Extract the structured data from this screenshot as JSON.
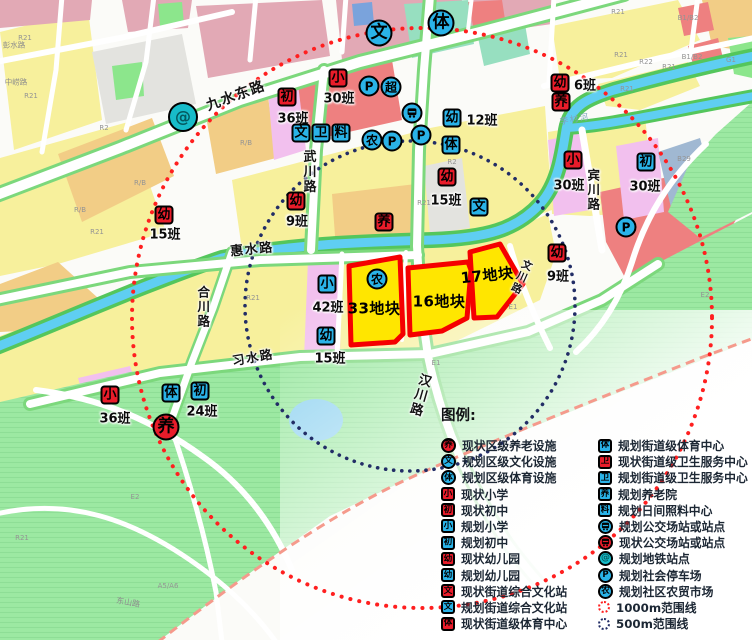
{
  "colors": {
    "marker_red": "#e91c2a",
    "marker_blue": "#2ab3e8",
    "metro_teal": "#17bcc9",
    "plot_fill": "#ffe600",
    "plot_stroke": "#f50000",
    "range_1000": "#ff1f1f",
    "range_500": "#222d66"
  },
  "map": {
    "plots": [
      {
        "name": "33地块",
        "x": 374,
        "y": 308,
        "rot": 0
      },
      {
        "name": "16地块",
        "x": 439,
        "y": 301,
        "rot": 0
      },
      {
        "name": "17地块",
        "x": 487,
        "y": 275,
        "rot": -6
      }
    ],
    "markers": [
      {
        "t": "ci",
        "c": "teal",
        "g": "METRO",
        "x": 183,
        "y": 117,
        "big": 1,
        "n": "metro-station"
      },
      {
        "t": "ci",
        "c": "blue",
        "g": "文",
        "x": 379,
        "y": 33,
        "big": 1,
        "n": "district-culture"
      },
      {
        "t": "ci",
        "c": "blue",
        "g": "体",
        "x": 441,
        "y": 23,
        "big": 1,
        "n": "district-sports"
      },
      {
        "t": "sq",
        "c": "red",
        "g": "初",
        "x": 287,
        "y": 97,
        "lbl": "36班",
        "lx": 293,
        "ly": 117
      },
      {
        "t": "sq",
        "c": "red",
        "g": "小",
        "x": 338,
        "y": 78,
        "lbl": "30班",
        "lx": 339,
        "ly": 97
      },
      {
        "t": "ci",
        "c": "blue",
        "g": "P",
        "x": 369,
        "y": 86
      },
      {
        "t": "ci",
        "c": "blue",
        "g": "超",
        "x": 391,
        "y": 87
      },
      {
        "t": "ci",
        "c": "blue",
        "g": "BUS",
        "x": 412,
        "y": 113,
        "n": "planned-bus-stop"
      },
      {
        "t": "ci",
        "c": "blue",
        "g": "P",
        "x": 421,
        "y": 135
      },
      {
        "t": "sq",
        "c": "blue",
        "g": "幼",
        "x": 452,
        "y": 118,
        "lbl": "12班",
        "lx": 482,
        "ly": 119
      },
      {
        "t": "sq",
        "c": "blue",
        "g": "体",
        "x": 451,
        "y": 145
      },
      {
        "t": "sq",
        "c": "blue",
        "g": "文",
        "x": 301,
        "y": 133
      },
      {
        "t": "sq",
        "c": "blue",
        "g": "卫",
        "x": 321,
        "y": 133
      },
      {
        "t": "sq",
        "c": "blue",
        "g": "料",
        "x": 341,
        "y": 133
      },
      {
        "t": "ci",
        "c": "blue",
        "g": "农",
        "x": 372,
        "y": 140
      },
      {
        "t": "ci",
        "c": "blue",
        "g": "P",
        "x": 392,
        "y": 141
      },
      {
        "t": "sq",
        "c": "red",
        "g": "幼",
        "x": 560,
        "y": 83,
        "lbl": "6班",
        "lx": 585,
        "ly": 84
      },
      {
        "t": "sq",
        "c": "red",
        "g": "养",
        "x": 561,
        "y": 102
      },
      {
        "t": "sq",
        "c": "red",
        "g": "小",
        "x": 573,
        "y": 160,
        "lbl": "30班",
        "lx": 569,
        "ly": 184
      },
      {
        "t": "sq",
        "c": "blue",
        "g": "初",
        "x": 646,
        "y": 162,
        "lbl": "30班",
        "lx": 645,
        "ly": 185
      },
      {
        "t": "ci",
        "c": "blue",
        "g": "P",
        "x": 626,
        "y": 227
      },
      {
        "t": "sq",
        "c": "red",
        "g": "幼",
        "x": 164,
        "y": 215,
        "lbl": "15班",
        "lx": 165,
        "ly": 233
      },
      {
        "t": "sq",
        "c": "red",
        "g": "幼",
        "x": 296,
        "y": 201,
        "lbl": "9班",
        "lx": 297,
        "ly": 220
      },
      {
        "t": "sq",
        "c": "red",
        "g": "养",
        "x": 384,
        "y": 222
      },
      {
        "t": "sq",
        "c": "red",
        "g": "幼",
        "x": 447,
        "y": 177,
        "lbl": "15班",
        "lx": 446,
        "ly": 199
      },
      {
        "t": "sq",
        "c": "blue",
        "g": "文",
        "x": 479,
        "y": 207
      },
      {
        "t": "sq",
        "c": "red",
        "g": "幼",
        "x": 557,
        "y": 253,
        "lbl": "9班",
        "lx": 558,
        "ly": 275
      },
      {
        "t": "ci",
        "c": "blue",
        "g": "农",
        "x": 377,
        "y": 279
      },
      {
        "t": "sq",
        "c": "blue",
        "g": "小",
        "x": 327,
        "y": 284,
        "lbl": "42班",
        "lx": 328,
        "ly": 306
      },
      {
        "t": "sq",
        "c": "blue",
        "g": "幼",
        "x": 326,
        "y": 336,
        "lbl": "15班",
        "lx": 330,
        "ly": 357
      },
      {
        "t": "sq",
        "c": "red",
        "g": "小",
        "x": 110,
        "y": 395,
        "lbl": "36班",
        "lx": 115,
        "ly": 417
      },
      {
        "t": "sq",
        "c": "blue",
        "g": "体",
        "x": 171,
        "y": 393
      },
      {
        "t": "sq",
        "c": "blue",
        "g": "初",
        "x": 200,
        "y": 391,
        "lbl": "24班",
        "lx": 202,
        "ly": 410
      },
      {
        "t": "ci",
        "c": "red",
        "g": "养",
        "x": 166,
        "y": 427,
        "big": 1,
        "n": "existing-elderly-care"
      }
    ],
    "road_labels": [
      {
        "t": "九水东路",
        "x": 236,
        "y": 96,
        "r": -20,
        "s": 14
      },
      {
        "t": "武川路",
        "x": 308,
        "y": 172,
        "v": 1,
        "s": 13
      },
      {
        "t": "惠水路",
        "x": 252,
        "y": 250,
        "r": -6,
        "s": 13
      },
      {
        "t": "合川路",
        "x": 202,
        "y": 307,
        "v": 1,
        "s": 12.5
      },
      {
        "t": "习水路",
        "x": 253,
        "y": 358,
        "r": -10,
        "s": 12.5
      },
      {
        "t": "汉川路",
        "x": 419,
        "y": 395,
        "v": 1,
        "r": 16,
        "s": 13
      },
      {
        "t": "宾川路",
        "x": 592,
        "y": 190,
        "v": 1,
        "s": 12.5
      },
      {
        "t": "文川路",
        "x": 521,
        "y": 277,
        "v": 1,
        "r": 24,
        "s": 10.5
      },
      {
        "t": "李村河",
        "x": 575,
        "y": 120,
        "r": -10,
        "s": 8.5,
        "c": "water"
      },
      {
        "t": "彭水路",
        "x": 14,
        "y": 45,
        "s": 7.5,
        "c": "gray"
      },
      {
        "t": "中崂路",
        "x": 16,
        "y": 82,
        "s": 7.5,
        "c": "gray"
      },
      {
        "t": "东山路",
        "x": 128,
        "y": 603,
        "r": 10,
        "s": 8,
        "c": "gray"
      }
    ],
    "parcel_labels": [
      {
        "t": "R21",
        "x": 25,
        "y": 38
      },
      {
        "t": "R21",
        "x": 31,
        "y": 96
      },
      {
        "t": "R2",
        "x": 104,
        "y": 128
      },
      {
        "t": "R/B",
        "x": 140,
        "y": 183
      },
      {
        "t": "R/B",
        "x": 80,
        "y": 210
      },
      {
        "t": "R/B",
        "x": 246,
        "y": 143
      },
      {
        "t": "R21",
        "x": 97,
        "y": 232
      },
      {
        "t": "R2",
        "x": 452,
        "y": 162
      },
      {
        "t": "R21",
        "x": 424,
        "y": 203
      },
      {
        "t": "R21",
        "x": 253,
        "y": 298
      },
      {
        "t": "E2",
        "x": 135,
        "y": 497
      },
      {
        "t": "R21",
        "x": 22,
        "y": 538
      },
      {
        "t": "A5/A6",
        "x": 168,
        "y": 586
      },
      {
        "t": "R21",
        "x": 618,
        "y": 12
      },
      {
        "t": "R21",
        "x": 621,
        "y": 55
      },
      {
        "t": "R22",
        "x": 646,
        "y": 62
      },
      {
        "t": "R21",
        "x": 669,
        "y": 67
      },
      {
        "t": "R21",
        "x": 627,
        "y": 89
      },
      {
        "t": "B1/B2",
        "x": 688,
        "y": 18
      },
      {
        "t": "B1/B2",
        "x": 692,
        "y": 57
      },
      {
        "t": "G1",
        "x": 731,
        "y": 60
      },
      {
        "t": "B29",
        "x": 684,
        "y": 159
      },
      {
        "t": "E2",
        "x": 705,
        "y": 295
      },
      {
        "t": "E1",
        "x": 513,
        "y": 307
      },
      {
        "t": "E1",
        "x": 436,
        "y": 363
      }
    ]
  },
  "legend": {
    "title": "图例:",
    "left": [
      {
        "shape": "ci",
        "color": "red",
        "glyph": "养",
        "label": "现状区级养老设施"
      },
      {
        "shape": "ci",
        "color": "blue",
        "glyph": "文",
        "label": "规划区级文化设施"
      },
      {
        "shape": "ci",
        "color": "blue",
        "glyph": "体",
        "label": "规划区级体育设施"
      },
      {
        "shape": "sq",
        "color": "red",
        "glyph": "小",
        "label": "现状小学"
      },
      {
        "shape": "sq",
        "color": "red",
        "glyph": "初",
        "label": "现状初中"
      },
      {
        "shape": "sq",
        "color": "blue",
        "glyph": "小",
        "label": "规划小学"
      },
      {
        "shape": "sq",
        "color": "blue",
        "glyph": "初",
        "label": "规划初中"
      },
      {
        "shape": "sq",
        "color": "red",
        "glyph": "幼",
        "label": "现状幼儿园"
      },
      {
        "shape": "sq",
        "color": "blue",
        "glyph": "幼",
        "label": "规划幼儿园"
      },
      {
        "shape": "sq",
        "color": "red",
        "glyph": "文",
        "label": "现状街道综合文化站"
      },
      {
        "shape": "sq",
        "color": "blue",
        "glyph": "文",
        "label": "规划街道综合文化站"
      },
      {
        "shape": "sq",
        "color": "red",
        "glyph": "体",
        "label": "现状街道级体育中心"
      }
    ],
    "right": [
      {
        "shape": "sq",
        "color": "blue",
        "glyph": "体",
        "label": "规划街道级体育中心"
      },
      {
        "shape": "sq",
        "color": "red",
        "glyph": "卫",
        "label": "现状街道级卫生服务中心"
      },
      {
        "shape": "sq",
        "color": "blue",
        "glyph": "卫",
        "label": "规划街道级卫生服务中心"
      },
      {
        "shape": "sq",
        "color": "blue",
        "glyph": "养",
        "label": "规划养老院"
      },
      {
        "shape": "sq",
        "color": "blue",
        "glyph": "料",
        "label": "规划日间照料中心"
      },
      {
        "shape": "ci",
        "color": "blue",
        "glyph": "BUS",
        "label": "规划公交场站或站点"
      },
      {
        "shape": "ci",
        "color": "red",
        "glyph": "BUS",
        "label": "现状公交场站或站点"
      },
      {
        "shape": "ci",
        "color": "teal",
        "glyph": "METRO",
        "label": "规划地铁站点"
      },
      {
        "shape": "ci",
        "color": "blue",
        "glyph": "P",
        "label": "规划社会停车场"
      },
      {
        "shape": "ci",
        "color": "blue",
        "glyph": "农",
        "label": "规划社区农贸市场"
      },
      {
        "shape": "dot",
        "color": "red1000",
        "glyph": "",
        "label": "1000m范围线"
      },
      {
        "shape": "dot",
        "color": "navy500",
        "glyph": "",
        "label": "500m范围线"
      }
    ]
  }
}
